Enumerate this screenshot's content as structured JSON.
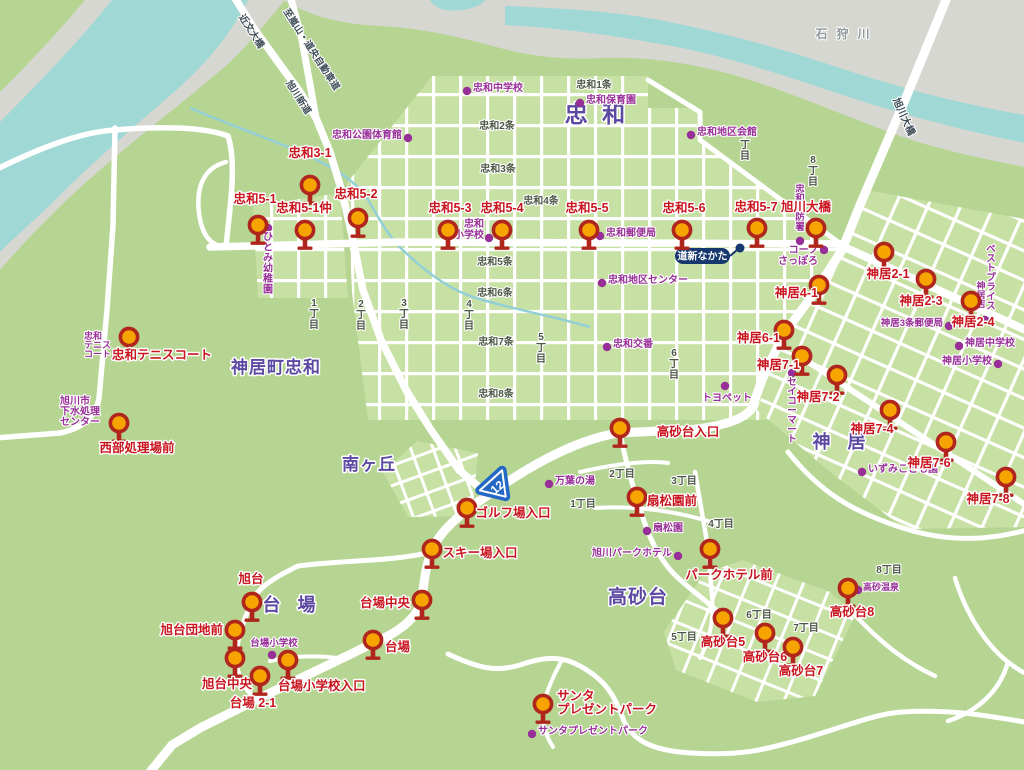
{
  "colors": {
    "land": "#b6d593",
    "block": "#c7e0a3",
    "water": "#a0d8d6",
    "bank": "#d6d7d0",
    "stream": "#93cfd6",
    "road": "#ffffff",
    "pin_fill": "#f7a400",
    "pin_stroke": "#b0251c",
    "stop_label": "#c9151e",
    "poi": "#982f98",
    "area_label": "#5c4aa2",
    "district_label": "#4d5746",
    "road_label": "#3e4d57",
    "river_label": "#90999c",
    "badge": "#16386e",
    "shield": "#2268c4"
  },
  "bus_stops": [
    {
      "label": "忠和3-1",
      "pin": [
        310,
        185
      ],
      "text": [
        310,
        157
      ]
    },
    {
      "label": "忠和5-1",
      "pin": [
        258,
        225
      ],
      "text": [
        255,
        203
      ]
    },
    {
      "label": "忠和5-1仲",
      "pin": [
        305,
        230
      ],
      "text": [
        304,
        212
      ]
    },
    {
      "label": "忠和5-2",
      "pin": [
        358,
        218
      ],
      "text": [
        356,
        198
      ]
    },
    {
      "label": "忠和5-3",
      "pin": [
        448,
        230
      ],
      "text": [
        450,
        212
      ]
    },
    {
      "label": "忠和5-4",
      "pin": [
        502,
        230
      ],
      "text": [
        502,
        212
      ]
    },
    {
      "label": "忠和5-5",
      "pin": [
        589,
        230
      ],
      "text": [
        587,
        212
      ]
    },
    {
      "label": "忠和5-6",
      "pin": [
        682,
        230
      ],
      "text": [
        684,
        212
      ]
    },
    {
      "label": "忠和5-7",
      "pin": [
        757,
        228
      ],
      "text": [
        756,
        211
      ]
    },
    {
      "label": "旭川大橋",
      "pin": [
        816,
        228
      ],
      "text": [
        806,
        211
      ]
    },
    {
      "label": "忠和テニスコート",
      "pin": [
        129,
        337
      ],
      "text": [
        162,
        359
      ]
    },
    {
      "label": "西部処理場前",
      "pin": [
        119,
        423
      ],
      "text": [
        137,
        452
      ]
    },
    {
      "label": "高砂台入口",
      "pin": [
        620,
        428
      ],
      "text": [
        688,
        436
      ],
      "anchor": "middle"
    },
    {
      "label": "ゴルフ場入口",
      "pin": [
        467,
        508
      ],
      "text": [
        513,
        517
      ]
    },
    {
      "label": "スキー場入口",
      "pin": [
        432,
        549
      ],
      "text": [
        480,
        557
      ]
    },
    {
      "label": "台場中央",
      "pin": [
        422,
        600
      ],
      "text": [
        410,
        607
      ],
      "anchor": "end"
    },
    {
      "label": "台場",
      "pin": [
        373,
        640
      ],
      "text": [
        385,
        651
      ],
      "anchor": "start"
    },
    {
      "label": "旭台",
      "pin": [
        252,
        602
      ],
      "text": [
        251,
        583
      ]
    },
    {
      "label": "旭台団地前",
      "pin": [
        235,
        630
      ],
      "text": [
        223,
        634
      ],
      "anchor": "end"
    },
    {
      "label": "旭台中央",
      "pin": [
        235,
        658
      ],
      "text": [
        252,
        688
      ],
      "anchor": "end"
    },
    {
      "label": "台場 2-1",
      "pin": [
        260,
        676
      ],
      "text": [
        253,
        707
      ]
    },
    {
      "label": "台場小学校入口",
      "pin": [
        288,
        660
      ],
      "text": [
        278,
        690
      ],
      "anchor": "start"
    },
    {
      "label": "サンタプレゼントパーク",
      "pin": [
        543,
        704
      ],
      "lines": [
        "サンタ",
        "プレゼントパーク"
      ],
      "text": [
        557,
        700
      ],
      "anchor": "start"
    },
    {
      "label": "高砂台5",
      "pin": [
        723,
        618
      ],
      "text": [
        723,
        646
      ]
    },
    {
      "label": "高砂台6",
      "pin": [
        765,
        633
      ],
      "text": [
        765,
        661
      ]
    },
    {
      "label": "高砂台7",
      "pin": [
        793,
        647
      ],
      "text": [
        801,
        675
      ]
    },
    {
      "label": "高砂台8",
      "pin": [
        848,
        588
      ],
      "text": [
        852,
        616
      ]
    },
    {
      "label": "パークホテル前",
      "pin": [
        710,
        549
      ],
      "text": [
        729,
        579
      ]
    },
    {
      "label": "扇松園前",
      "pin": [
        637,
        497
      ],
      "text": [
        672,
        505
      ]
    },
    {
      "label": "神居4-1",
      "pin": [
        819,
        285
      ],
      "text": [
        818,
        297
      ],
      "anchor": "end"
    },
    {
      "label": "神居6-1",
      "pin": [
        784,
        330
      ],
      "text": [
        780,
        342
      ],
      "anchor": "end"
    },
    {
      "label": "神居7-1",
      "pin": [
        802,
        356
      ],
      "text": [
        800,
        369
      ],
      "anchor": "end"
    },
    {
      "label": "神居7-2",
      "pin": [
        837,
        375
      ],
      "text": [
        818,
        401
      ]
    },
    {
      "label": "神居7-4",
      "pin": [
        890,
        410
      ],
      "text": [
        872,
        433
      ]
    },
    {
      "label": "神居7-6",
      "pin": [
        946,
        442
      ],
      "text": [
        929,
        467
      ]
    },
    {
      "label": "神居7-8",
      "pin": [
        1006,
        477
      ],
      "text": [
        988,
        503
      ]
    },
    {
      "label": "神居2-1",
      "pin": [
        884,
        252
      ],
      "text": [
        888,
        278
      ]
    },
    {
      "label": "神居2-3",
      "pin": [
        926,
        279
      ],
      "text": [
        921,
        305
      ]
    },
    {
      "label": "神居2-4",
      "pin": [
        971,
        301
      ],
      "text": [
        973,
        326
      ]
    }
  ],
  "pois": [
    {
      "label": "忠和中学校",
      "dot": [
        467,
        91
      ],
      "text": [
        473,
        91
      ],
      "anchor": "start"
    },
    {
      "label": "忠和保育園",
      "dot": [
        580,
        103
      ],
      "text": [
        586,
        103
      ],
      "anchor": "start"
    },
    {
      "label": "忠和公園体育館",
      "dot": [
        408,
        138
      ],
      "text": [
        402,
        138
      ],
      "anchor": "end"
    },
    {
      "label": "忠和地区会館",
      "dot": [
        691,
        135
      ],
      "text": [
        697,
        135
      ],
      "anchor": "start"
    },
    {
      "label": "忠和郵便局",
      "dot": [
        600,
        236
      ],
      "text": [
        606,
        236
      ],
      "anchor": "start"
    },
    {
      "label": "忠和地区センター",
      "dot": [
        602,
        283
      ],
      "text": [
        608,
        283
      ],
      "anchor": "start"
    },
    {
      "label": "忠和交番",
      "dot": [
        607,
        347
      ],
      "text": [
        613,
        347
      ],
      "anchor": "start"
    },
    {
      "label": "忠和小学校",
      "lines": [
        "忠和",
        "小学校"
      ],
      "dot": [
        489,
        238
      ],
      "text": [
        484,
        227
      ],
      "anchor": "end",
      "lh": 11
    },
    {
      "label": "ひとみ幼稚園",
      "dot": [
        268,
        228
      ],
      "text": [
        268,
        240
      ],
      "vertical": true,
      "lh": 10.5
    },
    {
      "label": "旭川市下水処理センター",
      "lines": [
        "旭川市",
        "下水処理",
        "センター"
      ],
      "text": [
        60,
        404
      ],
      "anchor": "start",
      "lh": 10.5
    },
    {
      "label": "忠和テニスコート",
      "lines": [
        "忠和",
        "テニス",
        "コート"
      ],
      "text": [
        84,
        339
      ],
      "anchor": "start",
      "lh": 9,
      "size": 9
    },
    {
      "label": "台場小学校",
      "dot": [
        272,
        655
      ],
      "text": [
        274,
        646
      ],
      "anchor": "middle",
      "size": 9.5
    },
    {
      "label": "万葉の湯",
      "dot": [
        549,
        484
      ],
      "text": [
        555,
        484
      ],
      "anchor": "start"
    },
    {
      "label": "扇松園",
      "dot": [
        647,
        531
      ],
      "text": [
        653,
        531
      ],
      "anchor": "start"
    },
    {
      "label": "旭川パークホテル",
      "dot": [
        678,
        556
      ],
      "text": [
        672,
        556
      ],
      "anchor": "end"
    },
    {
      "label": "サンタプレゼントパーク",
      "dot": [
        532,
        734
      ],
      "text": [
        538,
        734
      ],
      "anchor": "start"
    },
    {
      "label": "トヨペット",
      "dot": [
        725,
        386
      ],
      "text": [
        727,
        401
      ],
      "anchor": "middle"
    },
    {
      "label": "セイコーマート",
      "dot": [
        792,
        373
      ],
      "text": [
        792,
        385
      ],
      "vertical": true,
      "lh": 9.5,
      "size": 9.5
    },
    {
      "label": "コープさっぽろ",
      "lines": [
        "コープ",
        "さっぽろ"
      ],
      "dot": [
        824,
        250
      ],
      "text": [
        818,
        253
      ],
      "anchor": "end",
      "lh": 11
    },
    {
      "label": "神居3条郵便局",
      "dot": [
        949,
        326
      ],
      "text": [
        943,
        326
      ],
      "anchor": "end",
      "size": 9.5
    },
    {
      "label": "神居中学校",
      "dot": [
        959,
        346
      ],
      "text": [
        965,
        346
      ],
      "anchor": "start"
    },
    {
      "label": "神居小学校",
      "dot": [
        998,
        364
      ],
      "text": [
        992,
        364
      ],
      "anchor": "end"
    },
    {
      "label": "ベストプライス",
      "text": [
        991,
        252
      ],
      "vertical": true,
      "lh": 9.5,
      "size": 9.5
    },
    {
      "label": "神居店",
      "dot": [
        985,
        320
      ],
      "text": [
        981,
        289
      ],
      "vertical": true,
      "lh": 9,
      "size": 9
    },
    {
      "label": "いずみこども園",
      "dot": [
        862,
        472
      ],
      "text": [
        868,
        472
      ],
      "anchor": "start"
    },
    {
      "label": "高砂温泉",
      "dot": [
        858,
        590
      ],
      "text": [
        863,
        590
      ],
      "anchor": "start",
      "size": 9
    },
    {
      "label": "忠和消防署",
      "dot": [
        800,
        241
      ],
      "text": [
        800,
        192
      ],
      "vertical": true,
      "lh": 9.5,
      "size": 9.5
    }
  ],
  "district_labels": [
    {
      "text": "忠和1条",
      "pos": [
        594,
        88
      ]
    },
    {
      "text": "忠和2条",
      "pos": [
        497,
        129
      ]
    },
    {
      "text": "忠和3条",
      "pos": [
        498,
        172
      ]
    },
    {
      "text": "忠和4条",
      "pos": [
        541,
        204
      ]
    },
    {
      "text": "忠和5条",
      "pos": [
        495,
        265
      ]
    },
    {
      "text": "忠和6条",
      "pos": [
        495,
        296
      ]
    },
    {
      "text": "忠和7条",
      "pos": [
        496,
        345
      ]
    },
    {
      "text": "忠和8条",
      "pos": [
        496,
        397
      ]
    },
    {
      "text": "1丁目",
      "pos": [
        583,
        507
      ]
    },
    {
      "text": "2丁目",
      "pos": [
        622,
        477
      ]
    },
    {
      "text": "3丁目",
      "pos": [
        684,
        484
      ]
    },
    {
      "text": "4丁目",
      "pos": [
        721,
        527
      ]
    },
    {
      "text": "5丁目",
      "pos": [
        684,
        640
      ]
    },
    {
      "text": "6丁目",
      "pos": [
        759,
        618
      ]
    },
    {
      "text": "7丁目",
      "pos": [
        806,
        631
      ]
    },
    {
      "text": "8丁目",
      "pos": [
        889,
        573
      ]
    },
    {
      "text": "1丁目",
      "pos": [
        314,
        306
      ],
      "vertical": true
    },
    {
      "text": "2丁目",
      "pos": [
        361,
        307
      ],
      "vertical": true
    },
    {
      "text": "3丁目",
      "pos": [
        404,
        306
      ],
      "vertical": true
    },
    {
      "text": "4丁目",
      "pos": [
        469,
        307
      ],
      "vertical": true
    },
    {
      "text": "5丁目",
      "pos": [
        541,
        340
      ],
      "vertical": true
    },
    {
      "text": "6丁目",
      "pos": [
        674,
        356
      ],
      "vertical": true
    },
    {
      "text": "7丁目",
      "pos": [
        745,
        137
      ],
      "vertical": true
    },
    {
      "text": "8丁目",
      "pos": [
        813,
        163
      ],
      "vertical": true
    }
  ],
  "area_labels": [
    {
      "text": "忠 和",
      "pos": [
        597,
        122
      ],
      "size": 23,
      "ls": 4
    },
    {
      "text": "神居町忠和",
      "pos": [
        276,
        373
      ],
      "size": 17,
      "ls": 1
    },
    {
      "text": "南ヶ丘",
      "pos": [
        369,
        470
      ],
      "size": 17,
      "ls": 1
    },
    {
      "text": "神 居",
      "pos": [
        842,
        448
      ],
      "size": 18,
      "ls": 6
    },
    {
      "text": "台 場",
      "pos": [
        292,
        611
      ],
      "size": 18,
      "ls": 6
    },
    {
      "text": "高砂台",
      "pos": [
        638,
        603
      ],
      "size": 19,
      "ls": 1
    }
  ],
  "road_labels": [
    {
      "text": "近文大橋",
      "pos": [
        249,
        33
      ],
      "rotate": 57,
      "size": 9.5
    },
    {
      "text": "至嵐山・道央自動車道",
      "pos": [
        309,
        51
      ],
      "rotate": 57,
      "size": 9.5
    },
    {
      "text": "旭川新道",
      "pos": [
        296,
        99
      ],
      "rotate": 57,
      "size": 9.5
    },
    {
      "text": "旭川大橋",
      "pos": [
        901,
        118
      ],
      "rotate": 66,
      "size": 10
    }
  ],
  "river_label": {
    "text": "石狩川",
    "pos": [
      847,
      38
    ],
    "ls": 9,
    "size": 12
  },
  "badge": {
    "text": "道新なかた",
    "rect": [
      675,
      248,
      55,
      16
    ],
    "dot": [
      740,
      248
    ],
    "line": [
      730,
      256,
      737,
      250
    ]
  },
  "route_shield": {
    "number": "12",
    "pos": [
      497,
      487
    ],
    "rotate": -42
  }
}
